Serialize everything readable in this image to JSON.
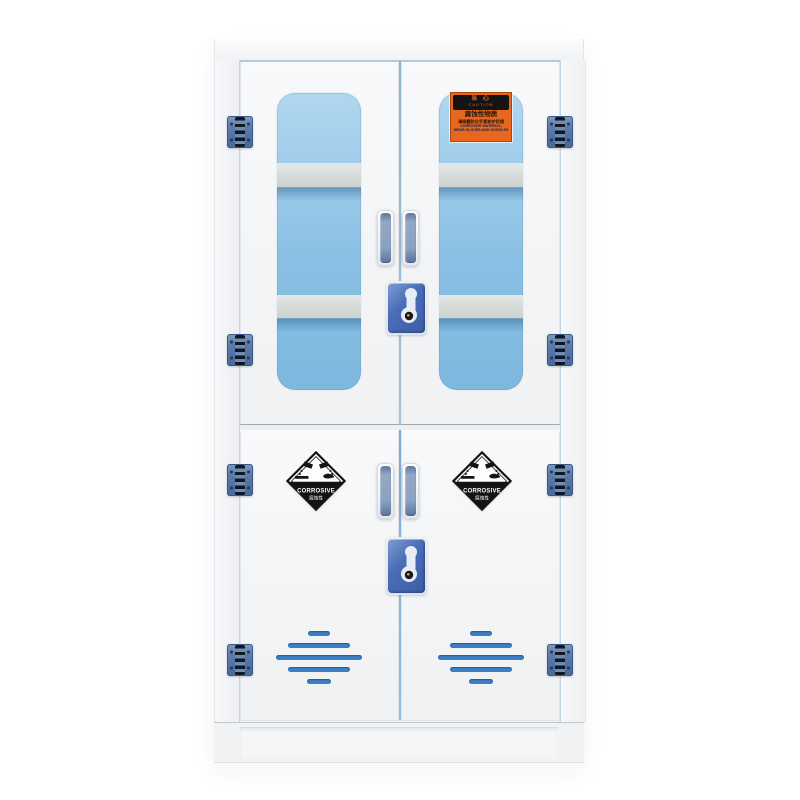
{
  "scene": {
    "description_colors": {
      "background": "#ffffff",
      "cabinet_body": "#f1f3f5",
      "door_face": "#f8f9fb",
      "glass_top": "#b0d7ef",
      "glass_bottom": "#7db8de",
      "shelf_band": "#d6dbd9",
      "hinge_blue": "#5a7bab",
      "handle_blue": "#8ba1c2",
      "lock_blue": "#4b6eb8",
      "vent_blue": "#3b7ec4",
      "door_gap_blue": "#8fb4cf",
      "caution_orange": "#e8671c",
      "label_black": "#141414"
    },
    "structure": {
      "hinge_count": 8,
      "handle_count": 4,
      "lock_count": 2,
      "window_count": 2,
      "shelves_visible_per_window": 2,
      "vent_rows_per_lower_door": 5,
      "corrosive_diamond_count": 2
    }
  },
  "caution_label": {
    "title_cn": "当 心",
    "title_en": "CAUTION",
    "line1_cn": "腐蚀性物质",
    "line2_cn": "请佩戴防化手套和护目镜",
    "line3_en": "CORROSIVE MATERIAL,",
    "line4_en": "WEAR GLOVES AND GOGGLES"
  },
  "corrosive_diamond": {
    "text_en": "CORROSIVE",
    "text_cn": "腐蚀性"
  },
  "icons": {
    "hinge": "door-hinge-icon",
    "handle": "door-handle",
    "keyhole": "keyhole-icon",
    "corrosive_pictogram": "corrosive-hazard-pictogram-icon",
    "vent": "vent-slot"
  }
}
